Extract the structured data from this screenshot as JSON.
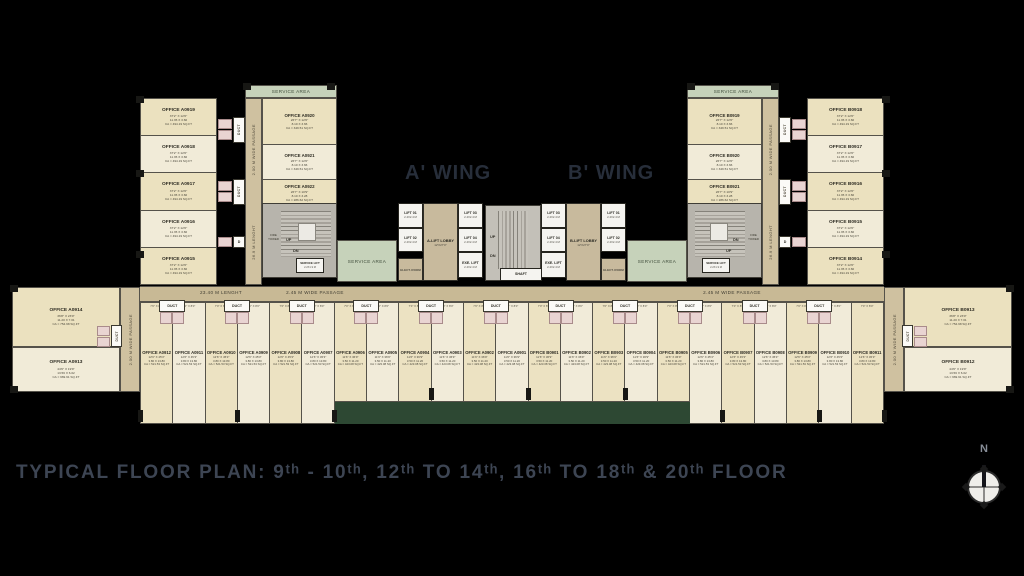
{
  "title": "TYPICAL FLOOR PLAN: 9ᵗʰ - 10ᵗʰ, 12ᵗʰ TO 14ᵗʰ, 16ᵗʰ TO 18ᵗʰ & 20ᵗʰ FLOOR",
  "wing_a": "A' WING",
  "wing_b": "B' WING",
  "compass_n": "N",
  "labels": {
    "service_area": "SERVICE AREA",
    "duct": "DUCT",
    "d": "D",
    "up": "UP",
    "dn": "DN",
    "shaft": "SHAFT",
    "fire_tower": "FIRE TOWER",
    "service_lift": "SERVICE LIFT",
    "service_lift_size": "2.2X1.9 M",
    "lift_size": "2.4X2.4 M",
    "exe_lift": "EXE. LIFT",
    "elect_room": "ELECT. ROOM",
    "lobby_size": "12'X27'0\"",
    "passage_200": "2.00 M WIDE PASSAGE",
    "length_269": "26.9 M LENGHT",
    "passage_245": "2.45 M WIDE PASSAGE",
    "length_2340": "23.40 M LENGHT",
    "unit_top": "7'0\" X 8'0\""
  },
  "core_a": {
    "l1": "LIFT 01",
    "l2": "LIFT 02",
    "l3": "LIFT 03",
    "l4": "LIFT 04",
    "lobby": "A-LIFT LOBBY"
  },
  "core_b": {
    "l1": "LIFT 01",
    "l2": "LIFT 02",
    "l3": "LIFT 03",
    "l4": "LIFT 04",
    "lobby": "B-LIFT LOBBY"
  },
  "left_wing": {
    "outer": [
      {
        "name": "OFFICE A0919",
        "l1": "37'2\" X 12'0\"",
        "l2": "11.35 X 3.66",
        "l3": "CA = 494.19 SQ.FT"
      },
      {
        "name": "OFFICE A0918",
        "l1": "37'2\" X 12'0\"",
        "l2": "11.35 X 3.66",
        "l3": "CA = 494.19 SQ.FT"
      },
      {
        "name": "OFFICE A0917",
        "l1": "37'2\" X 12'0\"",
        "l2": "11.35 X 3.66",
        "l3": "CA = 494.19 SQ.FT"
      },
      {
        "name": "OFFICE A0916",
        "l1": "37'2\" X 12'0\"",
        "l2": "11.35 X 3.66",
        "l3": "CA = 494.19 SQ.FT"
      },
      {
        "name": "OFFICE A0915",
        "l1": "37'2\" X 12'0\"",
        "l2": "11.35 X 3.66",
        "l3": "CA = 494.19 SQ.FT"
      }
    ],
    "inner": [
      {
        "name": "OFFICE A0920",
        "l1": "26'7\" X 12'0\"",
        "l2": "8.10 X 3.66",
        "l3": "CA = 349.51 SQ.FT"
      },
      {
        "name": "OFFICE A0921",
        "l1": "26'7\" X 12'0\"",
        "l2": "8.10 X 3.66",
        "l3": "CA = 349.51 SQ.FT"
      },
      {
        "name": "OFFICE A0922",
        "l1": "26'7\" X 10'9\"",
        "l2": "8.10 X 3.28",
        "l3": "CA = 286.62 SQ.FT"
      }
    ]
  },
  "right_wing": {
    "outer": [
      {
        "name": "OFFICE B0918",
        "l1": "37'2\" X 12'0\"",
        "l2": "11.35 X 3.66",
        "l3": "CA = 494.19 SQ.FT"
      },
      {
        "name": "OFFICE B0917",
        "l1": "37'2\" X 12'0\"",
        "l2": "11.35 X 3.66",
        "l3": "CA = 494.19 SQ.FT"
      },
      {
        "name": "OFFICE B0916",
        "l1": "37'2\" X 12'0\"",
        "l2": "11.35 X 3.66",
        "l3": "CA = 494.19 SQ.FT"
      },
      {
        "name": "OFFICE B0915",
        "l1": "37'2\" X 12'0\"",
        "l2": "11.35 X 3.66",
        "l3": "CA = 494.19 SQ.FT"
      },
      {
        "name": "OFFICE B0914",
        "l1": "37'2\" X 12'0\"",
        "l2": "11.35 X 3.66",
        "l3": "CA = 494.19 SQ.FT"
      }
    ],
    "inner": [
      {
        "name": "OFFICE B0919",
        "l1": "26'7\" X 12'0\"",
        "l2": "8.10 X 3.66",
        "l3": "CA = 349.51 SQ.FT"
      },
      {
        "name": "OFFICE B0920",
        "l1": "26'7\" X 12'0\"",
        "l2": "8.10 X 3.66",
        "l3": "CA = 349.51 SQ.FT"
      },
      {
        "name": "OFFICE B0921",
        "l1": "26'7\" X 10'9\"",
        "l2": "8.10 X 3.28",
        "l3": "CA = 286.62 SQ.FT"
      }
    ]
  },
  "end_left": {
    "top": {
      "name": "OFFICE A0914",
      "l1": "36'8\" X 23'0\"",
      "l2": "11.20 X 7.01",
      "l3": "CA = 754.98 SQ.FT"
    },
    "bottom": {
      "name": "OFFICE A0913",
      "l1": "44'6\" X 19'9\"",
      "l2": "13.56 X 6.02",
      "l3": "CA = 969.91 SQ.FT"
    }
  },
  "end_right": {
    "top": {
      "name": "OFFICE B0913",
      "l1": "36'8\" X 23'0\"",
      "l2": "11.20 X 7.01",
      "l3": "CA = 754.98 SQ.FT"
    },
    "bottom": {
      "name": "OFFICE B0912",
      "l1": "44'6\" X 19'9\"",
      "l2": "13.56 X 6.02",
      "l3": "CA = 969.91 SQ.FT"
    }
  },
  "strip": {
    "units": [
      {
        "name": "OFFICE A0912",
        "l1": "12'6\" X 45'3\"",
        "l2": "3.80 X 13.80",
        "l3": "CA = 521.53 SQ.FT"
      },
      {
        "name": "OFFICE A0911",
        "l1": "12'6\" X 45'3\"",
        "l2": "3.80 X 13.80",
        "l3": "CA = 521.53 SQ.FT"
      },
      {
        "name": "OFFICE A0910",
        "l1": "12'6\" X 45'3\"",
        "l2": "3.80 X 13.80",
        "l3": "CA = 521.53 SQ.FT"
      },
      {
        "name": "OFFICE A0909",
        "l1": "12'6\" X 45'3\"",
        "l2": "3.80 X 13.80",
        "l3": "CA = 521.53 SQ.FT"
      },
      {
        "name": "OFFICE A0908",
        "l1": "12'6\" X 45'3\"",
        "l2": "3.80 X 13.80",
        "l3": "CA = 521.53 SQ.FT"
      },
      {
        "name": "OFFICE A0907",
        "l1": "12'6\" X 45'3\"",
        "l2": "3.80 X 13.80",
        "l3": "CA = 521.53 SQ.FT"
      },
      {
        "name": "OFFICE A0906",
        "l1": "11'6\" X 36'9\"",
        "l2": "3.50 X 11.20",
        "l3": "CA = 423.08 SQ.FT"
      },
      {
        "name": "OFFICE A0905",
        "l1": "11'6\" X 36'9\"",
        "l2": "3.50 X 11.20",
        "l3": "CA = 423.08 SQ.FT"
      },
      {
        "name": "OFFICE A0904",
        "l1": "11'6\" X 36'9\"",
        "l2": "3.50 X 11.20",
        "l3": "CA = 423.08 SQ.FT"
      },
      {
        "name": "OFFICE A0903",
        "l1": "11'6\" X 36'9\"",
        "l2": "3.50 X 11.20",
        "l3": "CA = 423.08 SQ.FT"
      },
      {
        "name": "OFFICE A0902",
        "l1": "11'6\" X 36'9\"",
        "l2": "3.50 X 11.20",
        "l3": "CA = 423.08 SQ.FT"
      },
      {
        "name": "OFFICE A0901",
        "l1": "11'6\" X 36'9\"",
        "l2": "3.50 X 11.20",
        "l3": "CA = 423.08 SQ.FT"
      },
      {
        "name": "OFFICE B0901",
        "l1": "11'6\" X 36'9\"",
        "l2": "3.50 X 11.20",
        "l3": "CA = 423.08 SQ.FT"
      },
      {
        "name": "OFFICE B0902",
        "l1": "11'6\" X 36'9\"",
        "l2": "3.50 X 11.20",
        "l3": "CA = 423.08 SQ.FT"
      },
      {
        "name": "OFFICE B0903",
        "l1": "11'6\" X 36'9\"",
        "l2": "3.50 X 11.20",
        "l3": "CA = 423.08 SQ.FT"
      },
      {
        "name": "OFFICE B0904",
        "l1": "11'6\" X 36'9\"",
        "l2": "3.50 X 11.20",
        "l3": "CA = 423.08 SQ.FT"
      },
      {
        "name": "OFFICE B0905",
        "l1": "11'6\" X 36'9\"",
        "l2": "3.50 X 11.20",
        "l3": "CA = 423.08 SQ.FT"
      },
      {
        "name": "OFFICE B0906",
        "l1": "12'6\" X 45'3\"",
        "l2": "3.80 X 13.80",
        "l3": "CA = 521.53 SQ.FT"
      },
      {
        "name": "OFFICE B0907",
        "l1": "12'6\" X 45'3\"",
        "l2": "3.80 X 13.80",
        "l3": "CA = 521.53 SQ.FT"
      },
      {
        "name": "OFFICE B0908",
        "l1": "12'6\" X 45'3\"",
        "l2": "3.80 X 13.80",
        "l3": "CA = 521.53 SQ.FT"
      },
      {
        "name": "OFFICE B0909",
        "l1": "12'6\" X 45'3\"",
        "l2": "3.80 X 13.80",
        "l3": "CA = 521.53 SQ.FT"
      },
      {
        "name": "OFFICE B0910",
        "l1": "12'6\" X 45'3\"",
        "l2": "3.80 X 13.80",
        "l3": "CA = 521.53 SQ.FT"
      },
      {
        "name": "OFFICE B0911",
        "l1": "12'6\" X 45'3\"",
        "l2": "3.80 X 13.80",
        "l3": "CA = 521.53 SQ.FT"
      }
    ]
  }
}
